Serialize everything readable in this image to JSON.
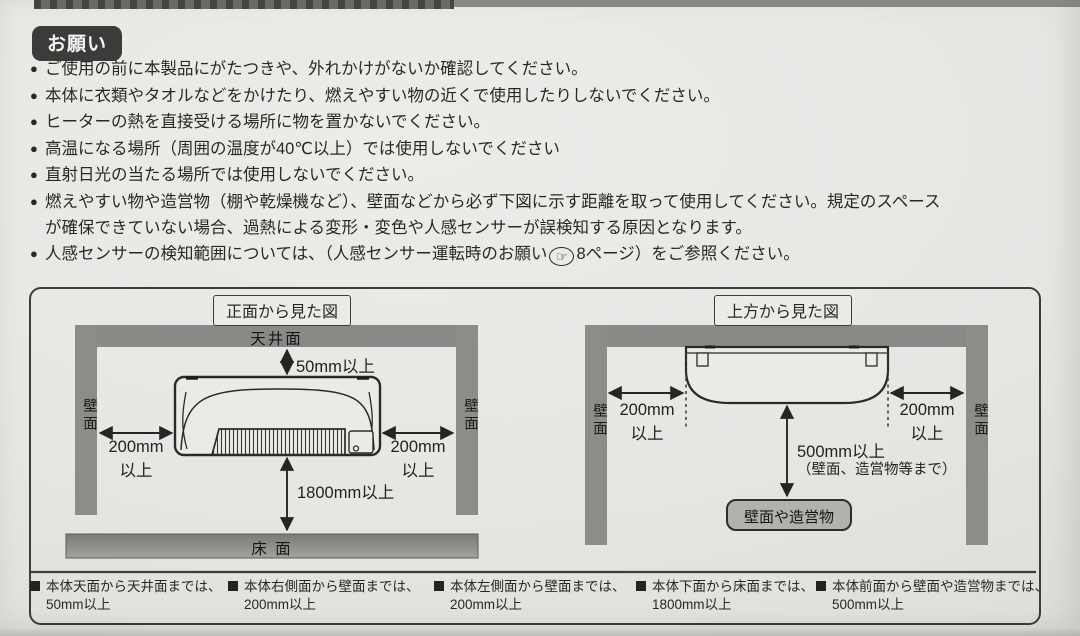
{
  "colors": {
    "paper": "#e8e6e3",
    "bar_gray": "#8b8987",
    "ink": "#292826",
    "badge_bg": "#3d3b39",
    "box_border": "#3d3c3a",
    "obstacle_fill": "#b3b1ad"
  },
  "bullet": "●",
  "header": {
    "badge": "お願い"
  },
  "notes": [
    {
      "text": "ご使用の前に本製品にがたつきや、外れかけがないか確認してください。"
    },
    {
      "text": "本体に衣類やタオルなどをかけたり、燃えやすい物の近くで使用したりしないでください。"
    },
    {
      "text": "ヒーターの熱を直接受ける場所に物を置かないでください。"
    },
    {
      "text": "高温になる場所（周囲の温度が40℃以上）では使用しないでください"
    },
    {
      "text": "直射日光の当たる場所では使用しないでください。"
    },
    {
      "text": "燃えやすい物や造営物（棚や乾燥機など）、壁面などから必ず下図に示す距離を取って使用してください。規定のスペース",
      "text2": "が確保できていない場合、過熱による変形・変色や人感センサーが誤検知する原因となります。"
    }
  ],
  "sensor_note": {
    "pre": "人感センサーの検知範囲については、（人感センサー運転時のお願い",
    "icon": "☞",
    "post": "8ページ）をご参照ください。"
  },
  "front_view": {
    "title": "正面から見た図",
    "ceiling": "天井面",
    "wall_left": "壁面",
    "wall_right": "壁面",
    "floor": "床 面",
    "clearance_top": "50mm以上",
    "clearance_left_value": "200mm",
    "clearance_left_unit": "以上",
    "clearance_right_value": "200mm",
    "clearance_right_unit": "以上",
    "clearance_bottom": "1800mm以上"
  },
  "top_view": {
    "title": "上方から見た図",
    "wall_left": "壁面",
    "wall_right": "壁面",
    "clearance_left_value": "200mm",
    "clearance_left_unit": "以上",
    "clearance_right_value": "200mm",
    "clearance_right_unit": "以上",
    "clearance_front_value": "500mm以上",
    "clearance_front_note": "（壁面、造営物等まで）",
    "obstacle": "壁面や造営物"
  },
  "legend": [
    {
      "label": "本体天面から天井面までは、",
      "value": "50mm以上"
    },
    {
      "label": "本体右側面から壁面までは、",
      "value": "200mm以上"
    },
    {
      "label": "本体左側面から壁面までは、",
      "value": "200mm以上"
    },
    {
      "label": "本体下面から床面までは、",
      "value": "1800mm以上"
    },
    {
      "label": "本体前面から壁面や造営物までは、",
      "value": "500mm以上"
    }
  ]
}
